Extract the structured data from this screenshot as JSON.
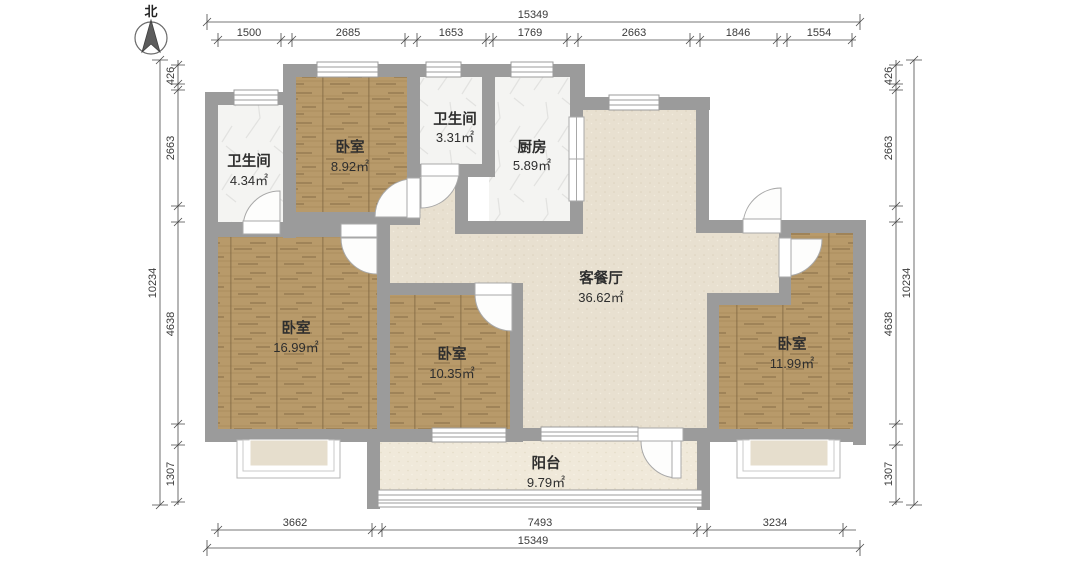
{
  "compass": {
    "label": "北"
  },
  "rooms": {
    "bath1": {
      "name": "卫生间",
      "area": "4.34㎡"
    },
    "bed_small": {
      "name": "卧室",
      "area": "8.92㎡"
    },
    "bath2": {
      "name": "卫生间",
      "area": "3.31㎡"
    },
    "kitchen": {
      "name": "厨房",
      "area": "5.89㎡"
    },
    "living": {
      "name": "客餐厅",
      "area": "36.62㎡"
    },
    "bed_left": {
      "name": "卧室",
      "area": "16.99㎡"
    },
    "bed_mid": {
      "name": "卧室",
      "area": "10.35㎡"
    },
    "bed_right": {
      "name": "卧室",
      "area": "11.99㎡"
    },
    "balcony": {
      "name": "阳台",
      "area": "9.79㎡"
    }
  },
  "dimensions": {
    "top_total": "15349",
    "top_segments": [
      "1500",
      "2685",
      "1653",
      "1769",
      "2663",
      "1846",
      "1554"
    ],
    "left_total": "10234",
    "left_segments": [
      "426",
      "2663",
      "4638",
      "1307"
    ],
    "right_total": "10234",
    "right_segments": [
      "426",
      "2663",
      "4638",
      "1307"
    ],
    "bottom_total": "15349",
    "bottom_segments": [
      "3662",
      "7493",
      "3234"
    ]
  },
  "colors": {
    "wall": "#9b9b9b",
    "wood": "#b79866",
    "tile": "#f4f4f2",
    "living_floor": "#e8e0d0",
    "balcony_floor": "#f0e9da",
    "dim_line": "#4a4a4a"
  }
}
